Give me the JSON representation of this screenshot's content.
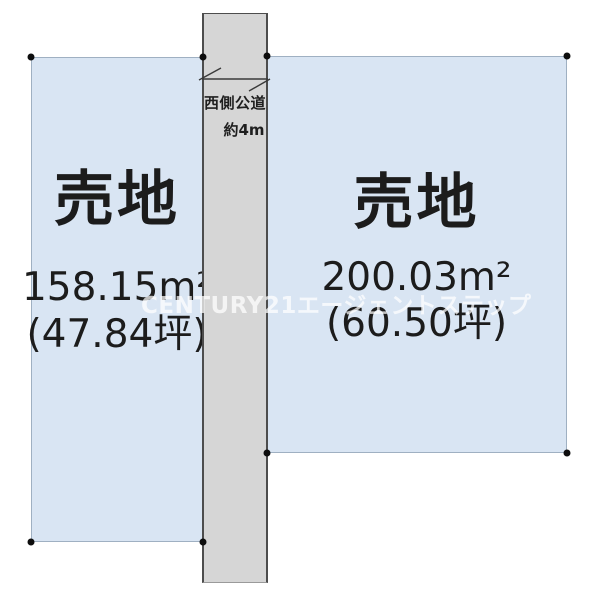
{
  "diagram": {
    "title": "land-sale-site-plan",
    "watermark": "CENTURY21エージェントステップ",
    "road": {
      "name": "西側公道",
      "width": "約4m"
    },
    "parcels": {
      "left": {
        "label": "売地",
        "area_m2": "158.15m²",
        "area_tsubo": "(47.84坪)"
      },
      "right": {
        "label": "売地",
        "area_m2": "200.03m²",
        "area_tsubo": "(60.50坪)"
      }
    },
    "colors": {
      "parcel_fill": "#d9e5f3",
      "parcel_border": "#9fb0c2",
      "road_fill": "#d6d6d6",
      "road_border": "#4d4d4d",
      "text": "#1c1c1c",
      "corner_marker": "#0d0d0d",
      "watermark": "rgba(255,255,255,0.72)"
    }
  }
}
